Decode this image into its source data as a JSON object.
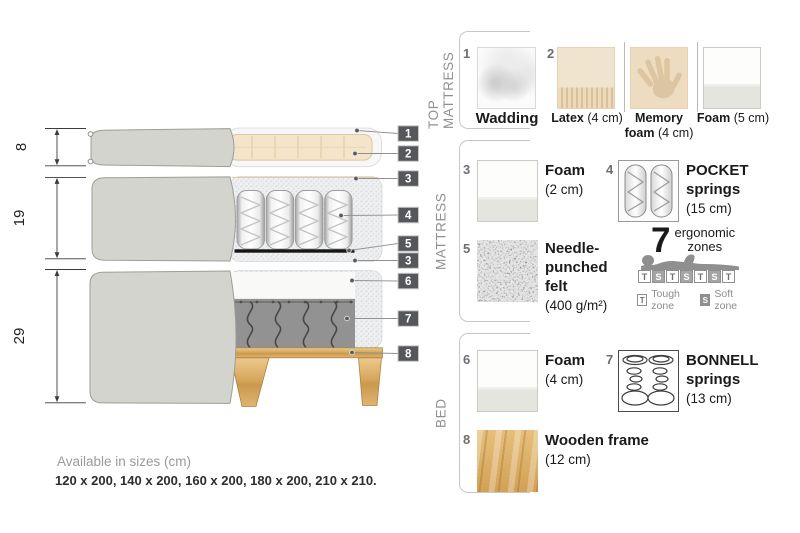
{
  "diagram": {
    "dims": [
      "8",
      "19",
      "29"
    ],
    "tags": [
      "1",
      "2",
      "3",
      "4",
      "5",
      "3",
      "6",
      "7",
      "8"
    ]
  },
  "legend": {
    "sections": {
      "top_mattress": {
        "label": "TOP MATTRESS",
        "wadding": {
          "num": "1",
          "name": "Wadding"
        },
        "latex": {
          "num": "2",
          "name": "Latex",
          "size": "(4 cm)"
        },
        "memory_foam": {
          "name_line1": "Memory",
          "name_line2": "foam",
          "size": "(4 cm)"
        },
        "foam": {
          "name": "Foam",
          "size": "(5 cm)"
        }
      },
      "mattress": {
        "label": "MATTRESS",
        "foam": {
          "num": "3",
          "name": "Foam",
          "size": "(2 cm)"
        },
        "pocket_springs": {
          "num": "4",
          "name_line1": "POCKET",
          "name_line2": "springs",
          "size": "(15 cm)"
        },
        "felt": {
          "num": "5",
          "name_line1": "Needle-",
          "name_line2": "punched",
          "name_line3": "felt",
          "size": "(400 g/m²)"
        },
        "zones": {
          "count": "7",
          "label_line1": "ergonomic",
          "label_line2": "zones",
          "boxes": [
            "T",
            "S",
            "T",
            "S",
            "T",
            "S",
            "T"
          ],
          "tough_key": "T",
          "tough_label": "Tough zone",
          "soft_key": "S",
          "soft_label": "Soft zone"
        }
      },
      "bed": {
        "label": "BED",
        "foam": {
          "num": "6",
          "name": "Foam",
          "size": "(4 cm)"
        },
        "bonnell_springs": {
          "num": "7",
          "name_line1": "BONNELL",
          "name_line2": "springs",
          "size": "(13 cm)"
        },
        "wooden_frame": {
          "num": "8",
          "name": "Wooden frame",
          "size": "(12 cm)"
        }
      }
    }
  },
  "footer": {
    "title": "Available in sizes (cm)",
    "sizes": "120 x 200, 140 x 200, 160 x 200, 180 x 200, 210 x 210."
  },
  "colors": {
    "tag_background": "#56575a",
    "cover_gray": "#d3d4cd",
    "wood": "#dfb26b",
    "label_gray": "#8f9092"
  }
}
